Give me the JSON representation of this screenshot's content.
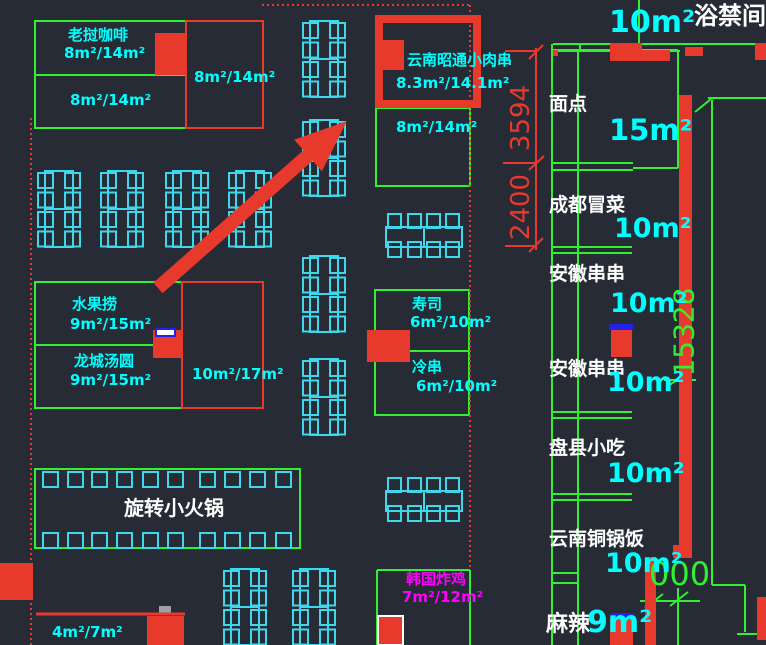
{
  "app": {
    "type": "cad-floor-plan",
    "background": "#262b35"
  },
  "colors": {
    "stall_outline_green": "#30f030",
    "furniture_cyan": "#3ed8ec",
    "text_cyan": "#00ffff",
    "wall_red": "#e7392c",
    "label_white": "#ffffff",
    "korean_magenta": "#ff00ff",
    "marker_blue": "#2222ee"
  },
  "stalls": {
    "laos_coffee": {
      "name": "老挝咖啡",
      "area_top": "8m²/14m²",
      "area_bottom": "8m²/14m²",
      "area_side": "8m²/14m²"
    },
    "highlighted": {
      "name": "云南昭通小肉串",
      "area": "8.3m²/14.1m²"
    },
    "below_highlight": {
      "area": "8m²/14m²"
    },
    "fruit": {
      "name": "水果捞",
      "area": "9m²/15m²"
    },
    "tangyuan": {
      "name": "龙城汤圆",
      "area": "9m²/15m²"
    },
    "mid_corner": {
      "area": "10m²/17m²"
    },
    "sushi": {
      "name": "寿司",
      "area": "6m²/10m²"
    },
    "cold_skewer": {
      "name": "冷串",
      "area": "6m²/10m²"
    },
    "hotpot": {
      "name": "旋转小火锅"
    },
    "korean_chicken": {
      "name": "韩国炸鸡",
      "area": "7m²/12m²"
    },
    "bottom_left": {
      "area": "4m²/7m²"
    },
    "right_column": [
      {
        "name": "面点",
        "area": "15m²"
      },
      {
        "name": "成都冒菜",
        "area": "10m²"
      },
      {
        "name": "安徽串串",
        "area": "10m²"
      },
      {
        "name": "安徽串串",
        "area": "10m²"
      },
      {
        "name": "盘县小吃",
        "area": "10m²"
      },
      {
        "name": "云南铜锅饭",
        "area": "10m²"
      },
      {
        "name": "麻辣",
        "area": "9m²"
      }
    ],
    "top_right": {
      "area": "10m²",
      "room": "浴禁间"
    }
  },
  "dimensions": {
    "vertical_upper": "3594",
    "vertical_lower": "2400",
    "right_wall": "15328",
    "bottom_right": "000"
  }
}
